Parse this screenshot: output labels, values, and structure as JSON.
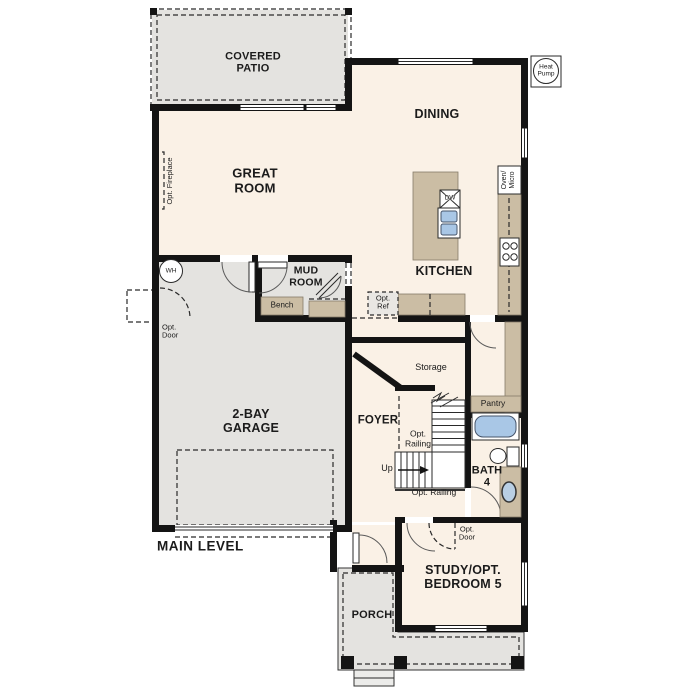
{
  "plan": {
    "title": "MAIN LEVEL",
    "rooms": {
      "covered_patio": "COVERED\nPATIO",
      "great_room": "GREAT\nROOM",
      "dining": "DINING",
      "kitchen": "KITCHEN",
      "mud_room": "MUD\nROOM",
      "garage": "2-BAY\nGARAGE",
      "foyer": "FOYER",
      "bath": "BATH\n4",
      "study": "STUDY/OPT.\nBEDROOM 5",
      "porch": "PORCH"
    },
    "annotations": {
      "opt_fireplace": "Opt. Fireplace",
      "wh": "WH",
      "opt_door_garage": "Opt.\nDoor",
      "bench": "Bench",
      "opt_ref": "Opt.\nRef",
      "storage": "Storage",
      "pantry": "Pantry",
      "up": "Up",
      "opt_railing_upper": "Opt.\nRailing",
      "opt_railing_lower": "Opt. Railing",
      "opt_door_study": "Opt.\nDoor",
      "dw": "DW",
      "oven_micro": "Oven/\nMicro",
      "heat_pump": "Heat\nPump"
    },
    "colors": {
      "wall": "#141414",
      "floor": "#faf1e6",
      "concrete": "#e4e3e0",
      "cabinet": "#cbbda4",
      "fixture_blue": "#a9c7e6",
      "background": "#ffffff"
    }
  }
}
